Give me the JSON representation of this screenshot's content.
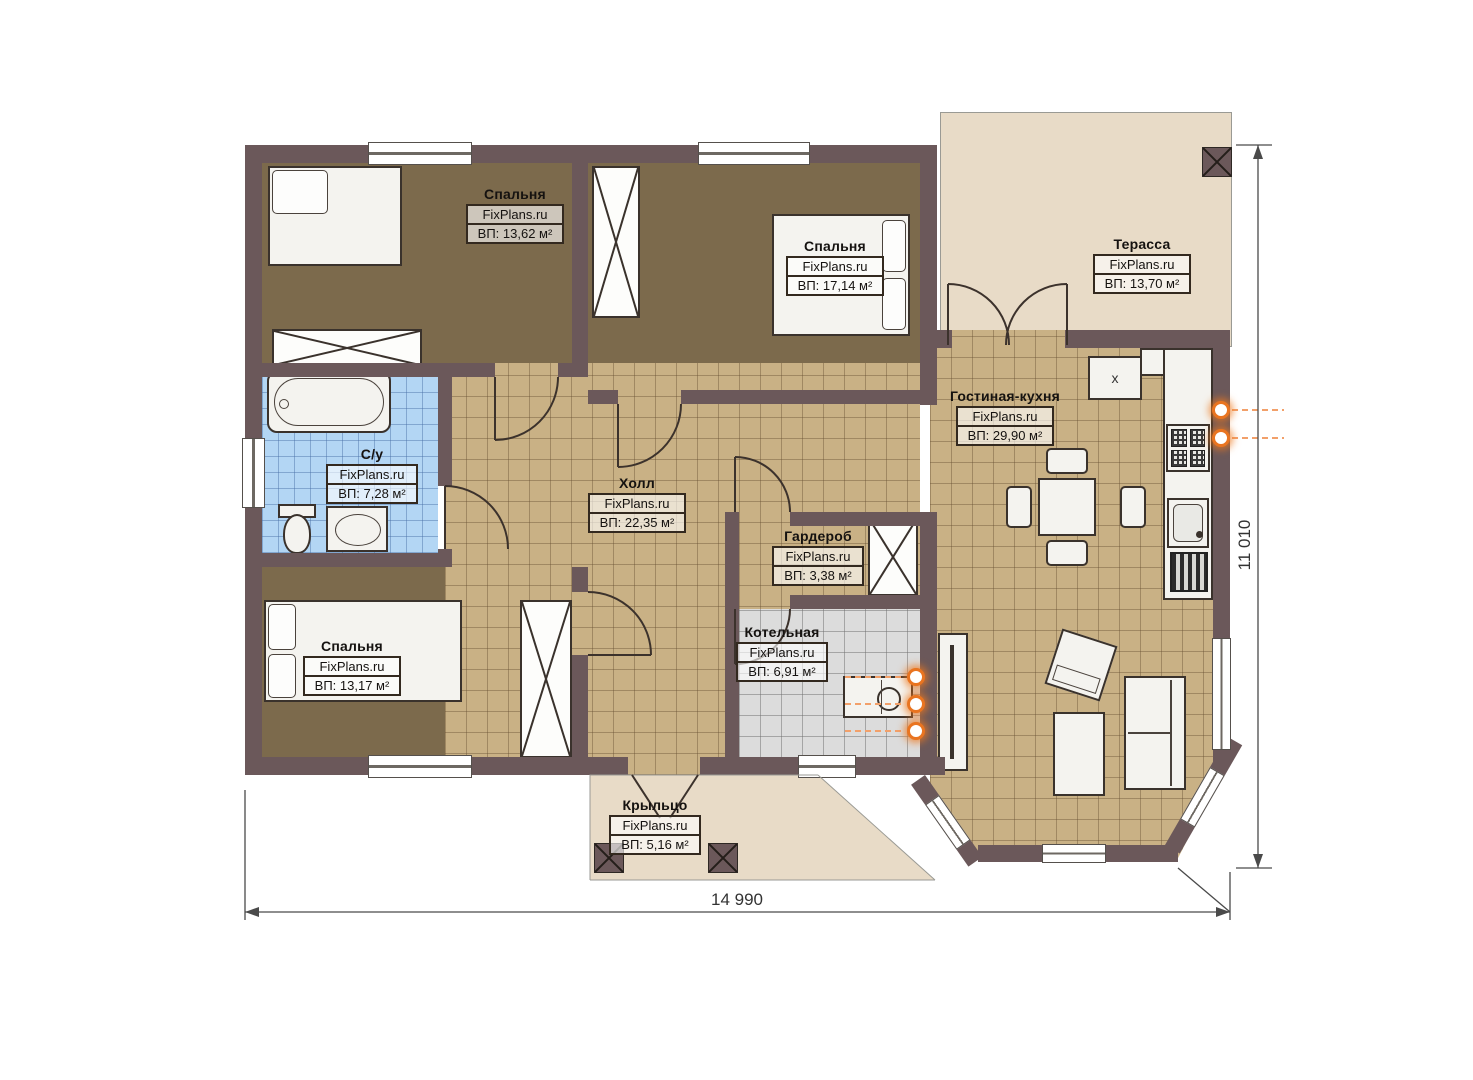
{
  "plan": {
    "rooms": [
      {
        "key": "bedroom-1",
        "name": "Спальня",
        "brand": "FixPlans.ru",
        "area": "ВП: 13,62 м²"
      },
      {
        "key": "bedroom-2",
        "name": "Спальня",
        "brand": "FixPlans.ru",
        "area": "ВП: 17,14 м²"
      },
      {
        "key": "terrace",
        "name": "Терасса",
        "brand": "FixPlans.ru",
        "area": "ВП: 13,70 м²"
      },
      {
        "key": "bathroom",
        "name": "С/у",
        "brand": "FixPlans.ru",
        "area": "ВП: 7,28 м²"
      },
      {
        "key": "hall",
        "name": "Холл",
        "brand": "FixPlans.ru",
        "area": "ВП: 22,35 м²"
      },
      {
        "key": "living-kitchen",
        "name": "Гостиная-кухня",
        "brand": "FixPlans.ru",
        "area": "ВП: 29,90 м²"
      },
      {
        "key": "wardrobe",
        "name": "Гардероб",
        "brand": "FixPlans.ru",
        "area": "ВП: 3,38 м²"
      },
      {
        "key": "boiler-room",
        "name": "Котельная",
        "brand": "FixPlans.ru",
        "area": "ВП: 6,91 м²"
      },
      {
        "key": "bedroom-3",
        "name": "Спальня",
        "brand": "FixPlans.ru",
        "area": "ВП: 13,17 м²"
      },
      {
        "key": "porch",
        "name": "Крыльцо",
        "brand": "FixPlans.ru",
        "area": "ВП: 5,16 м²"
      }
    ],
    "dimensions": {
      "bottom": "14 990",
      "right": "11 010"
    },
    "markers": {
      "kitchen_x": "х"
    },
    "colors": {
      "wall": "#6b585a",
      "bedroom_floor": "#7c6a4c",
      "tile": "#c9b185",
      "bathroom_tile": "#b3d6f4",
      "boiler_floor": "#dcdcdc",
      "terrace": "#e8dbc7",
      "utility_accent": "#e97420"
    }
  }
}
